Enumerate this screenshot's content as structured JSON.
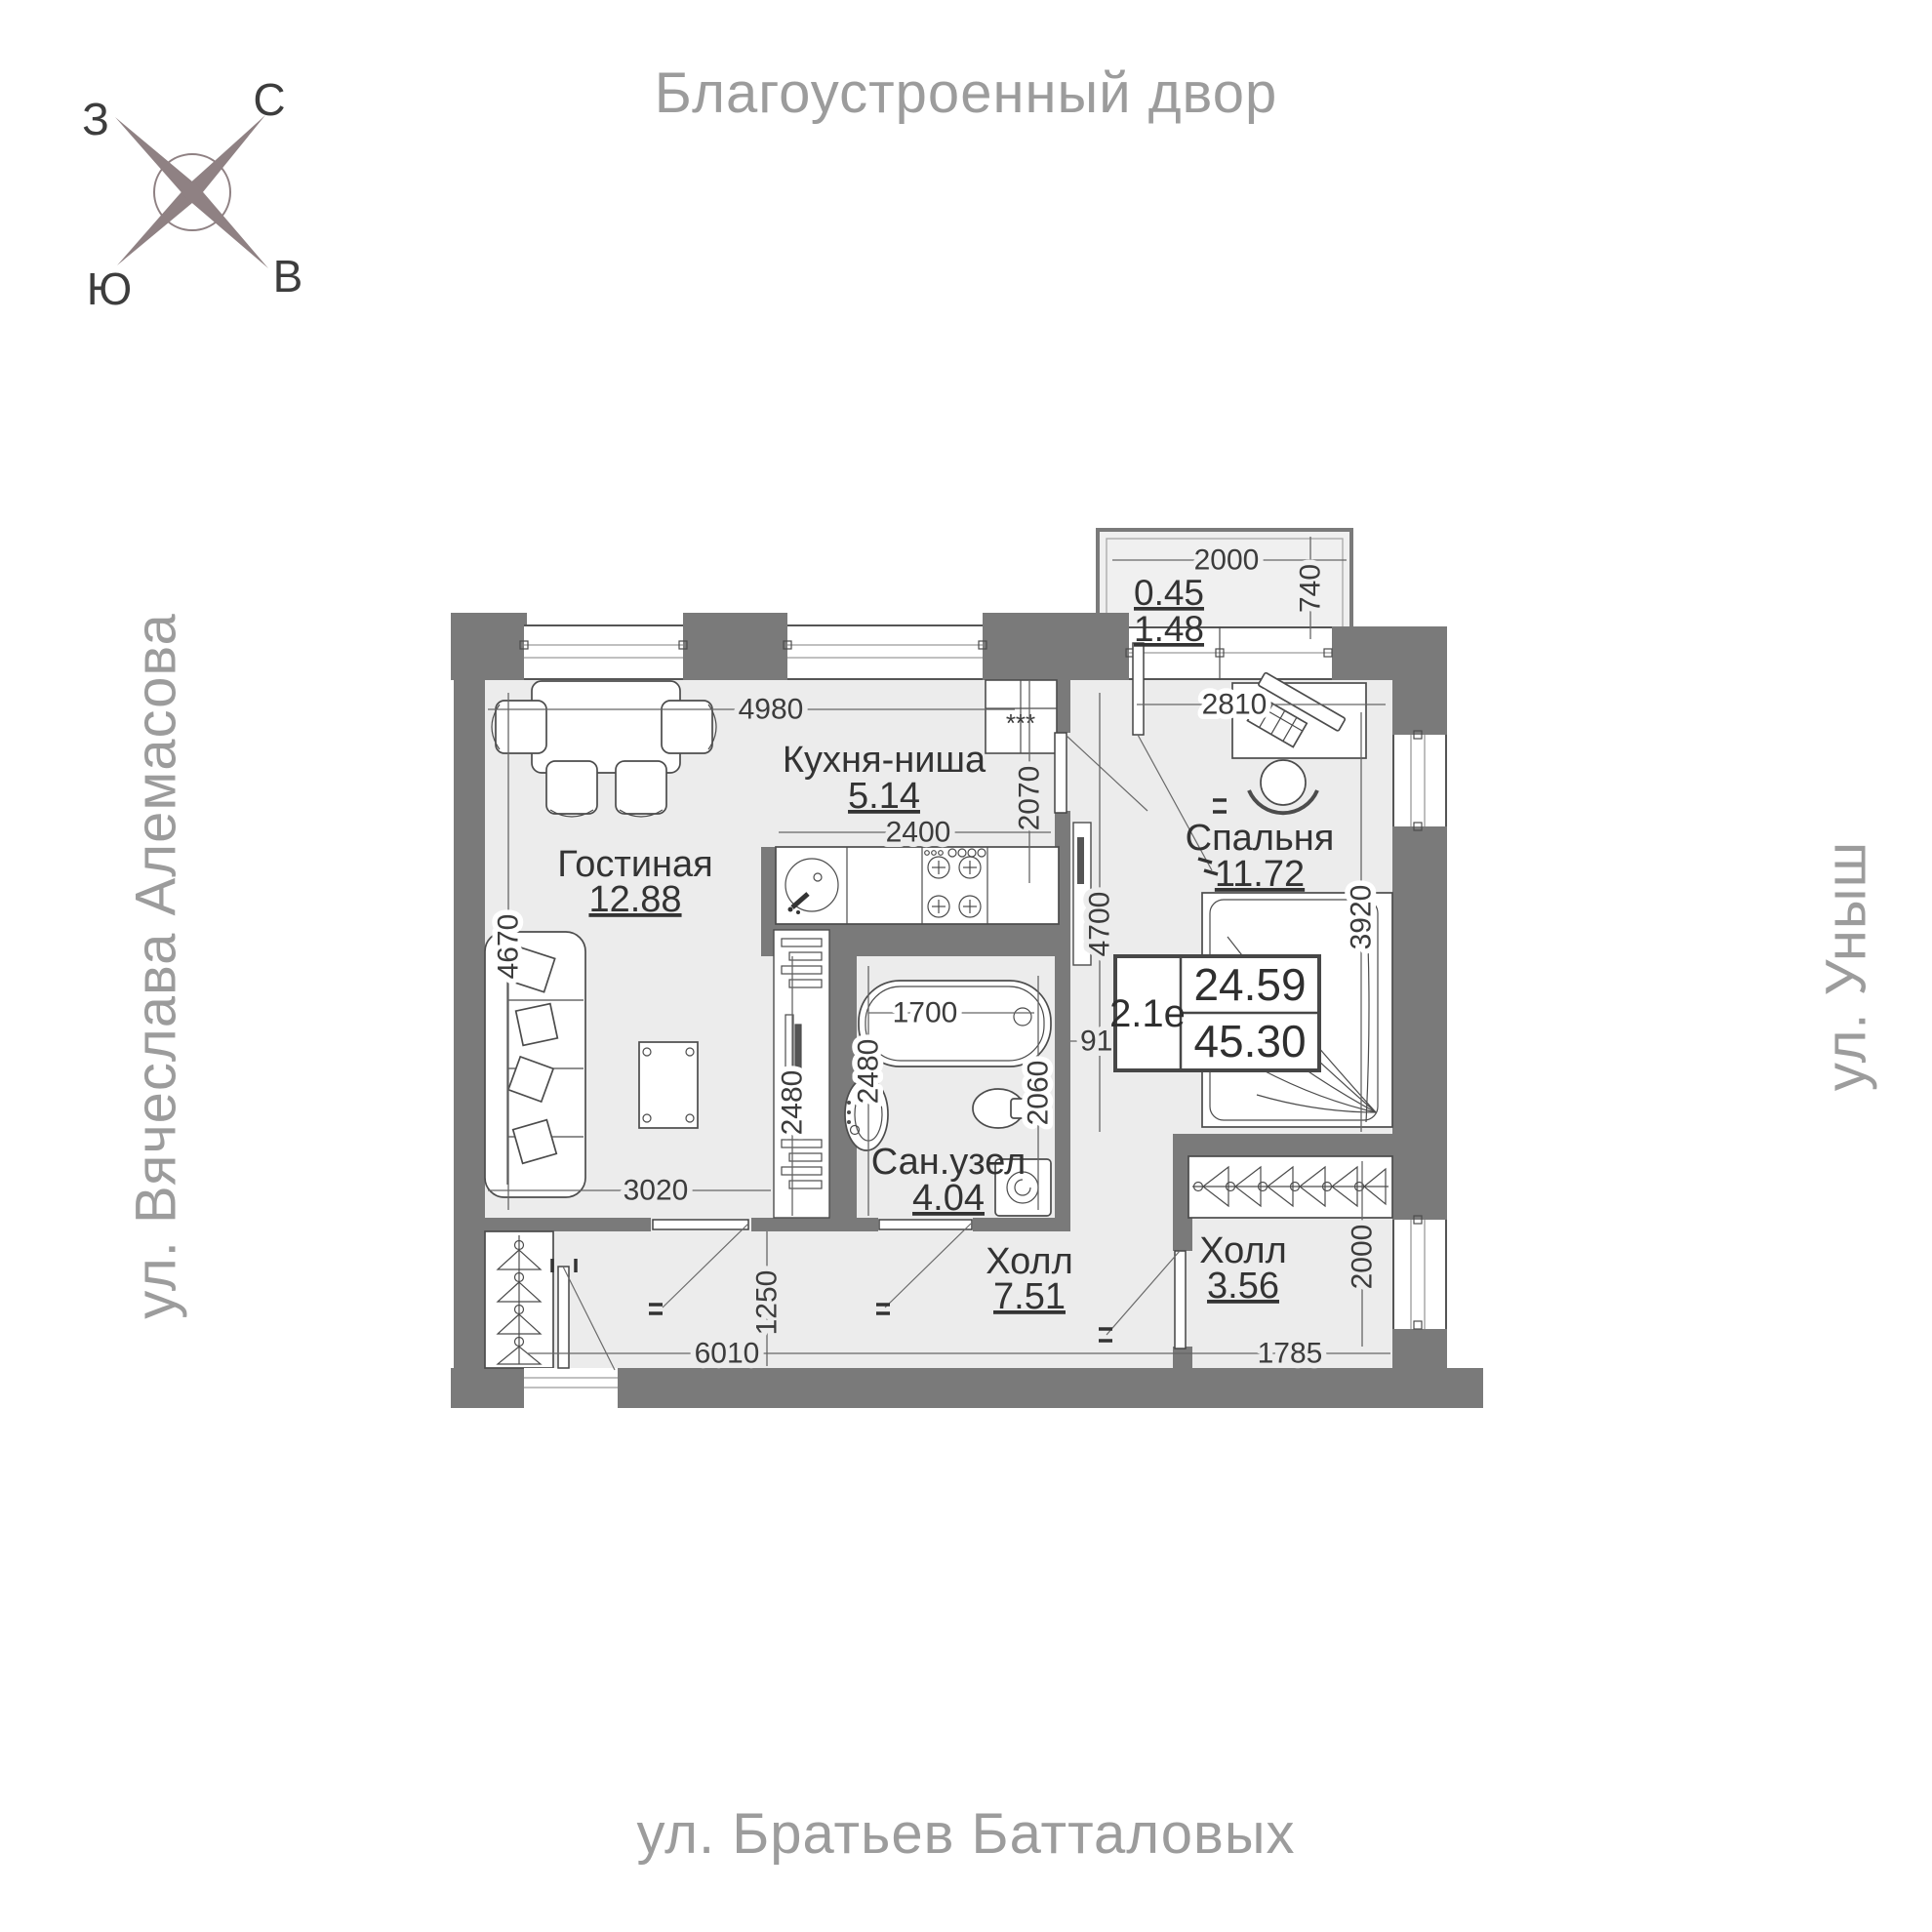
{
  "page": {
    "title_top": "Благоустроенный двор",
    "street_left": "ул. Вячеслава Алемасова",
    "street_right": "ул. Уныш",
    "street_bottom": "ул. Братьев Батталовых"
  },
  "compass": {
    "n": "С",
    "e": "В",
    "s": "Ю",
    "w": "З"
  },
  "unit": {
    "code": "2.1е",
    "area_living": "24.59",
    "area_total": "45.30"
  },
  "rooms": {
    "living": {
      "name": "Гостиная",
      "area": "12.88"
    },
    "kitchen": {
      "name": "Кухня-ниша",
      "area": "5.14"
    },
    "bedroom": {
      "name": "Спальня",
      "area": "11.72"
    },
    "bath": {
      "name": "Сан.узел",
      "area": "4.04"
    },
    "hall": {
      "name": "Холл",
      "area": "7.51"
    },
    "hall2": {
      "name": "Холл",
      "area": "3.56"
    },
    "balcony": {
      "area_reduced": "0.45",
      "area_full": "1.48"
    }
  },
  "dims": {
    "living_width": "4980",
    "living_height": "4670",
    "living_bottom": "3020",
    "kitchen_width": "2400",
    "kitchen_height": "2070",
    "kitchen_depth": "2480",
    "bedroom_width": "2810",
    "bedroom_height": "3920",
    "corridor_height": "4700",
    "corridor_width": "910",
    "balcony_width": "2000",
    "balcony_depth": "740",
    "bath_width": "1700",
    "bath_height": "2480",
    "bath_right": "2060",
    "hall_height": "1250",
    "hall_width": "6010",
    "hall2_width": "1785",
    "hall2_height": "2000"
  },
  "marks": {
    "vent": "***"
  },
  "colors": {
    "wall": "#7a7a7a",
    "floor": "#ececec",
    "street_text": "#9c9c9c",
    "compass": "#8f8183"
  }
}
